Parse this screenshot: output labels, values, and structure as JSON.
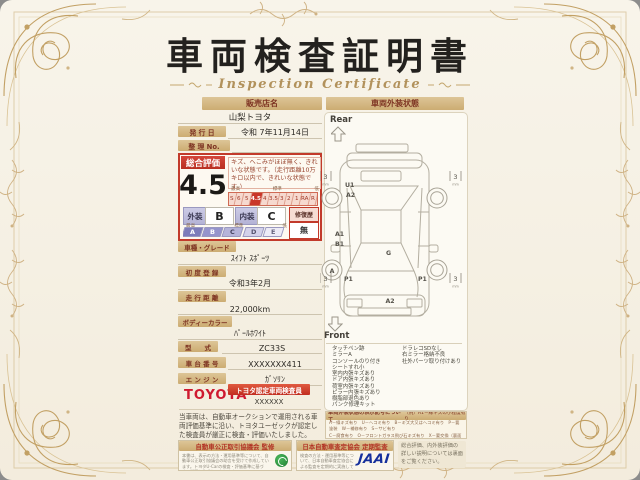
{
  "palette": {
    "accent_red": "#c23a2b",
    "bar_tan": "#ccac72",
    "toyota_red": "#cf1a30",
    "jaai_blue": "#16309c",
    "frame_gold": "#c2a064",
    "council_green": "#2f9e41"
  },
  "title": "車両検査証明書",
  "subtitle": "Inspection Certificate",
  "seller": {
    "label": "販売店名",
    "value": "山梨トヨタ"
  },
  "issue_date": {
    "label": "発 行 日",
    "value": "令和 7年11月14日"
  },
  "ref_no": {
    "label": "整 理 No.",
    "value": ""
  },
  "overall": {
    "label": "総合評価",
    "score": "4.5",
    "description": "キズ、へこみがほぼ無く、きれいな状態です。（走行距離10万キロ以内で、きれいな状態です。）",
    "scale_labels": {
      "high": "最高",
      "mid": "標準",
      "low": "低"
    },
    "scale": [
      "S",
      "6",
      "5",
      "4.5",
      "4",
      "3.5",
      "3",
      "2",
      "1",
      "RA",
      "R"
    ],
    "selected": "4.5"
  },
  "grades": {
    "exterior_label": "外装",
    "exterior": "B",
    "interior_label": "内装",
    "interior": "C",
    "repair_label": "修復歴",
    "repair": "無",
    "scale_labels": {
      "high": "最高",
      "mid": "標準",
      "low": "低"
    },
    "scale": [
      "A",
      "B",
      "C",
      "D",
      "E"
    ]
  },
  "fields": [
    {
      "label": "車種・グレード",
      "value": "ｽｲﾌﾄ ｽﾎﾟｰﾂ"
    },
    {
      "label": "初 度 登 録",
      "value": "令和3年2月"
    },
    {
      "label": "走 行 距 離",
      "value": "22,000km"
    },
    {
      "label": "ボディーカラー",
      "value": "ﾊﾟｰﾙﾎﾜｲﾄ"
    },
    {
      "label": "型　　式",
      "value": "ZC33S"
    },
    {
      "label": "車 台 番 号",
      "value": "XXXXXXX411"
    },
    {
      "label": "エ ン ジ ン",
      "value": "ｶﾞｿﾘﾝ"
    }
  ],
  "inspector": {
    "brand": "TOYOTA",
    "badge": "トヨタ認定車両検査員",
    "id": "XXXXXX"
  },
  "disclaimer": "当車両は、自動車オークションで運用される車両評価基準に沿い、トヨタユーゼックが認定した検査員が厳正に検査・評価いたしました。",
  "exterior_state": {
    "header": "車両外装状態",
    "rear": "Rear",
    "front": "Front",
    "tires": {
      "rear_left": "3",
      "rear_right": "3",
      "front_left": "3",
      "front_right": "3",
      "unit": "mm"
    },
    "marks": {
      "quarter_left_1": "U1",
      "quarter_left_2": "A2",
      "side_left_1": "A1",
      "side_left_2": "B1",
      "roof": "G",
      "wheel_front_left": "A",
      "door_left": "P1",
      "door_right": "P1",
      "front_bumper": "A2"
    },
    "conditions_left": [
      "タッチペン跡",
      "ミラーA",
      "コンソールのり付き",
      "シートすれ小",
      "室内内張キズあり",
      "ドア内張キズあり",
      "荷室内張キズあり",
      "ピラー内張キズあり",
      "樹脂部退色あり",
      "パンク修理キット"
    ],
    "conditions_right": [
      "ドラレコSDなし",
      "右ミラー格納不良",
      "社外パーツ取り付けあり"
    ],
    "code_note": {
      "header": "車両外装状態の表示記号について",
      "example": "（例）A1－線キズの小程度有り",
      "lines": [
        "A－線キズ有り　U－ヘコミ有り　B－キズ大又はヘコミ有り　P－要塗装　W－補修有り　S－サビ有り",
        "C－腐食有り　O－フロントガラス飛び石キズ有り　X－要交換（裏面に補修有り）　XX－交換済有り",
        "1－小程度　2－中程度　3－中程度以上　・タイヤ溝は裏面に記載しています。"
      ]
    }
  },
  "footer": {
    "council": {
      "header": "自動車公正取引協議会 監修",
      "body": "本書は、表示の方法・運用基準等について、自動車公正取引協議会の助言を受けて作成しています。トヨタU-Carの検査・評価基準に基づき、厳正に作成しております。"
    },
    "jaai": {
      "header": "日本自動車査定協会 定期監査",
      "body": "検査の方法・運用基準等について、日本自動車査定協会による監査を定期的に実施しています。",
      "logo": "JAAI"
    },
    "back_note": "総合評価、内外装評価の詳しい説明については裏面をご覧ください。"
  }
}
